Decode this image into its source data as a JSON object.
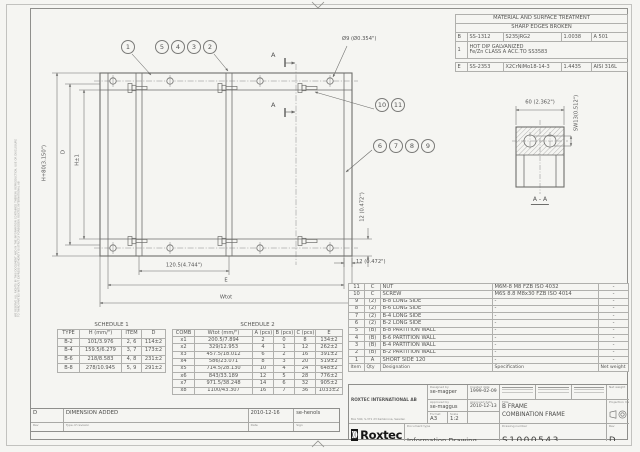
{
  "sheet": {
    "margin_note": "WE RESERVE ALL RIGHTS IN THIS DOCUMENT AND IN THE INFORMATION CONTAINED THEREIN. REPRODUCTION, USE OR DISCLOSURE TO THIRD PARTIES WITHOUT EXPRESS AUTHORITY IS STRICTLY FORBIDDEN. ROXTEC INTERNATIONAL AB"
  },
  "material_table": {
    "title": "MATERIAL AND SURFACE TREATMENT",
    "subtitle": "SHARP EDGES BROKEN",
    "row_b": {
      "code": "B",
      "std": "SS-1312",
      "grade": "S235JRG2",
      "wnr": "1.0038",
      "astm": "A 501"
    },
    "row_note": {
      "code": "1",
      "line1": "HOT DIP GALVANIZED",
      "line2": "Fe/Zn CLASS A ACC.TO SS3583"
    },
    "row_e": {
      "code": "E",
      "std": "SS-2353",
      "grade": "X2CrNiMo18-14-3",
      "wnr": "1.4435",
      "astm": "AISI 316L"
    }
  },
  "parts_list": {
    "headers": [
      "Item",
      "Qty",
      "Designation",
      "Specification",
      "Net weight"
    ],
    "rows": [
      [
        "11",
        "C",
        "NUT",
        "M6M-8 M8 FZB ISO 4032",
        "-"
      ],
      [
        "10",
        "C",
        "SCREW",
        "M6S 8.8 M8x30 FZB ISO 4014",
        "-"
      ],
      [
        "9",
        "(2)",
        "B-8 LONG SIDE",
        "-",
        "-"
      ],
      [
        "8",
        "(2)",
        "B-6 LONG SIDE",
        "-",
        "-"
      ],
      [
        "7",
        "(2)",
        "B-4 LONG SIDE",
        "-",
        "-"
      ],
      [
        "6",
        "(2)",
        "B-2 LONG SIDE",
        "-",
        "-"
      ],
      [
        "5",
        "(B)",
        "B-8 PARTITION WALL",
        "-",
        "-"
      ],
      [
        "4",
        "(B)",
        "B-6 PARTITION WALL",
        "-",
        "-"
      ],
      [
        "3",
        "(B)",
        "B-4 PARTITION WALL",
        "-",
        "-"
      ],
      [
        "2",
        "(B)",
        "B-2 PARTITION WALL",
        "-",
        "-"
      ],
      [
        "1",
        "A",
        "SHORT SIDE 120",
        "-",
        "-"
      ]
    ]
  },
  "schedule1": {
    "title": "SCHEDULE 1",
    "headers": [
      "TYPE",
      "H (mm/\")",
      "ITEM",
      "D"
    ],
    "rows": [
      [
        "B-2",
        "101/3.976",
        "2, 6",
        "114±2"
      ],
      [
        "B-4",
        "159.5/6.279",
        "3, 7",
        "173±2"
      ],
      [
        "B-6",
        "218/8.583",
        "4, 8",
        "231±2"
      ],
      [
        "B-8",
        "278/10.945",
        "5, 9",
        "291±2"
      ]
    ]
  },
  "schedule2": {
    "title": "SCHEDULE 2",
    "headers": [
      "COMB",
      "Wtot (mm/\")",
      "A (pcs)",
      "B (pcs)",
      "C (pcs)",
      "E"
    ],
    "rows": [
      [
        "x1",
        "200.5/7.894",
        "2",
        "0",
        "8",
        "134±2"
      ],
      [
        "x2",
        "329/12.953",
        "4",
        "1",
        "12",
        "262±2"
      ],
      [
        "x3",
        "457.5/18.012",
        "6",
        "2",
        "16",
        "391±2"
      ],
      [
        "x4",
        "586/23.071",
        "8",
        "3",
        "20",
        "519±2"
      ],
      [
        "x5",
        "714.5/28.130",
        "10",
        "4",
        "24",
        "648±2"
      ],
      [
        "x6",
        "843/33.189",
        "12",
        "5",
        "28",
        "776±2"
      ],
      [
        "x7",
        "971.5/38.248",
        "14",
        "6",
        "32",
        "905±2"
      ],
      [
        "x8",
        "1100/43.307",
        "16",
        "7",
        "36",
        "1033±2"
      ]
    ]
  },
  "revision": {
    "rev": "D",
    "description": "DIMENSION ADDED",
    "date": "2010-12-16",
    "sign": "se-henols",
    "labels": {
      "rev": "Rev",
      "type": "Type of revision",
      "date": "Date",
      "sign": "Sign"
    }
  },
  "title_block": {
    "company": "ROXTEC INTERNATIONAL AB",
    "address1": "Box 540, S-371 23 Karlskrona, Sweden",
    "address2": "TEL +46 455 36 67 00, FAX +46 455 820 12",
    "logo_mark": ")))",
    "logo_text": "Roxtec",
    "labels": {
      "designed_by": "Designed by",
      "created_date": "Created date",
      "approved_by": "Approved by",
      "approved_date": "Approved date",
      "format": "Format",
      "scale": "Scale",
      "title": "Title",
      "document_type": "Document type",
      "drawing_number": "Drawing number",
      "rev": "Rev",
      "projection": "Projection method",
      "net_weight": "Net weight"
    },
    "designed_by": "se-magper",
    "created_date": "1999-02-09",
    "approved_by": "se-maggus",
    "approved_date": "2010-12-13",
    "format": "A3",
    "scale": "1:2",
    "title_line1": "B FRAME",
    "title_line2": "COMBINATION FRAME",
    "document_type": "Information Drawing",
    "drawing_number": "S1000543",
    "rev": "D"
  },
  "drawing": {
    "balloons": [
      "1",
      "5",
      "4",
      "3",
      "2",
      "10",
      "11",
      "6",
      "7",
      "8",
      "9"
    ],
    "dims": {
      "hole_dia": "Ø9 (Ø0.354\")",
      "height_total": "H+80(3.150\")",
      "d": "D",
      "h": "H±1",
      "pitch": "120.5(4.744\")",
      "e": "E",
      "wtot": "Wtot",
      "offset_right": "12 (0.472\")",
      "offset_vert": "12 (0.472\")",
      "section_width": "60 (2.362\")",
      "sw": "SW13(0.512\")",
      "section_label": "A - A",
      "section_mark": "A"
    }
  }
}
